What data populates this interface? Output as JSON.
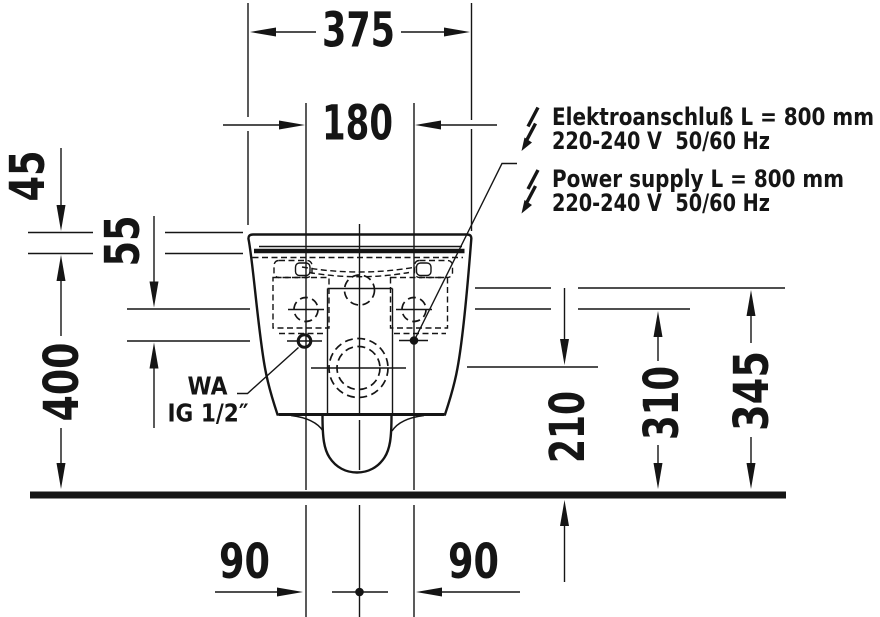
{
  "dims": {
    "overall_width": "375",
    "hinge_spacing": "180",
    "lid_thickness": "45",
    "hole_offset": "55",
    "rim_to_floor": "400",
    "outlet_center_height": "210",
    "fixing_height": "310",
    "inlet_height": "345",
    "outlet_offset_left": "90",
    "outlet_offset_right": "90"
  },
  "labels": {
    "water_connection": {
      "abbr": "WA",
      "thread": "IG 1/2″"
    },
    "electrical_de": {
      "line1": "Elektroanschluß L = 800 mm",
      "line2": "220-240 V  50/60 Hz"
    },
    "electrical_en": {
      "line1": "Power supply L = 800 mm",
      "line2": "220-240 V  50/60 Hz"
    }
  },
  "colors": {
    "ink": "#151515",
    "background": "#ffffff"
  }
}
